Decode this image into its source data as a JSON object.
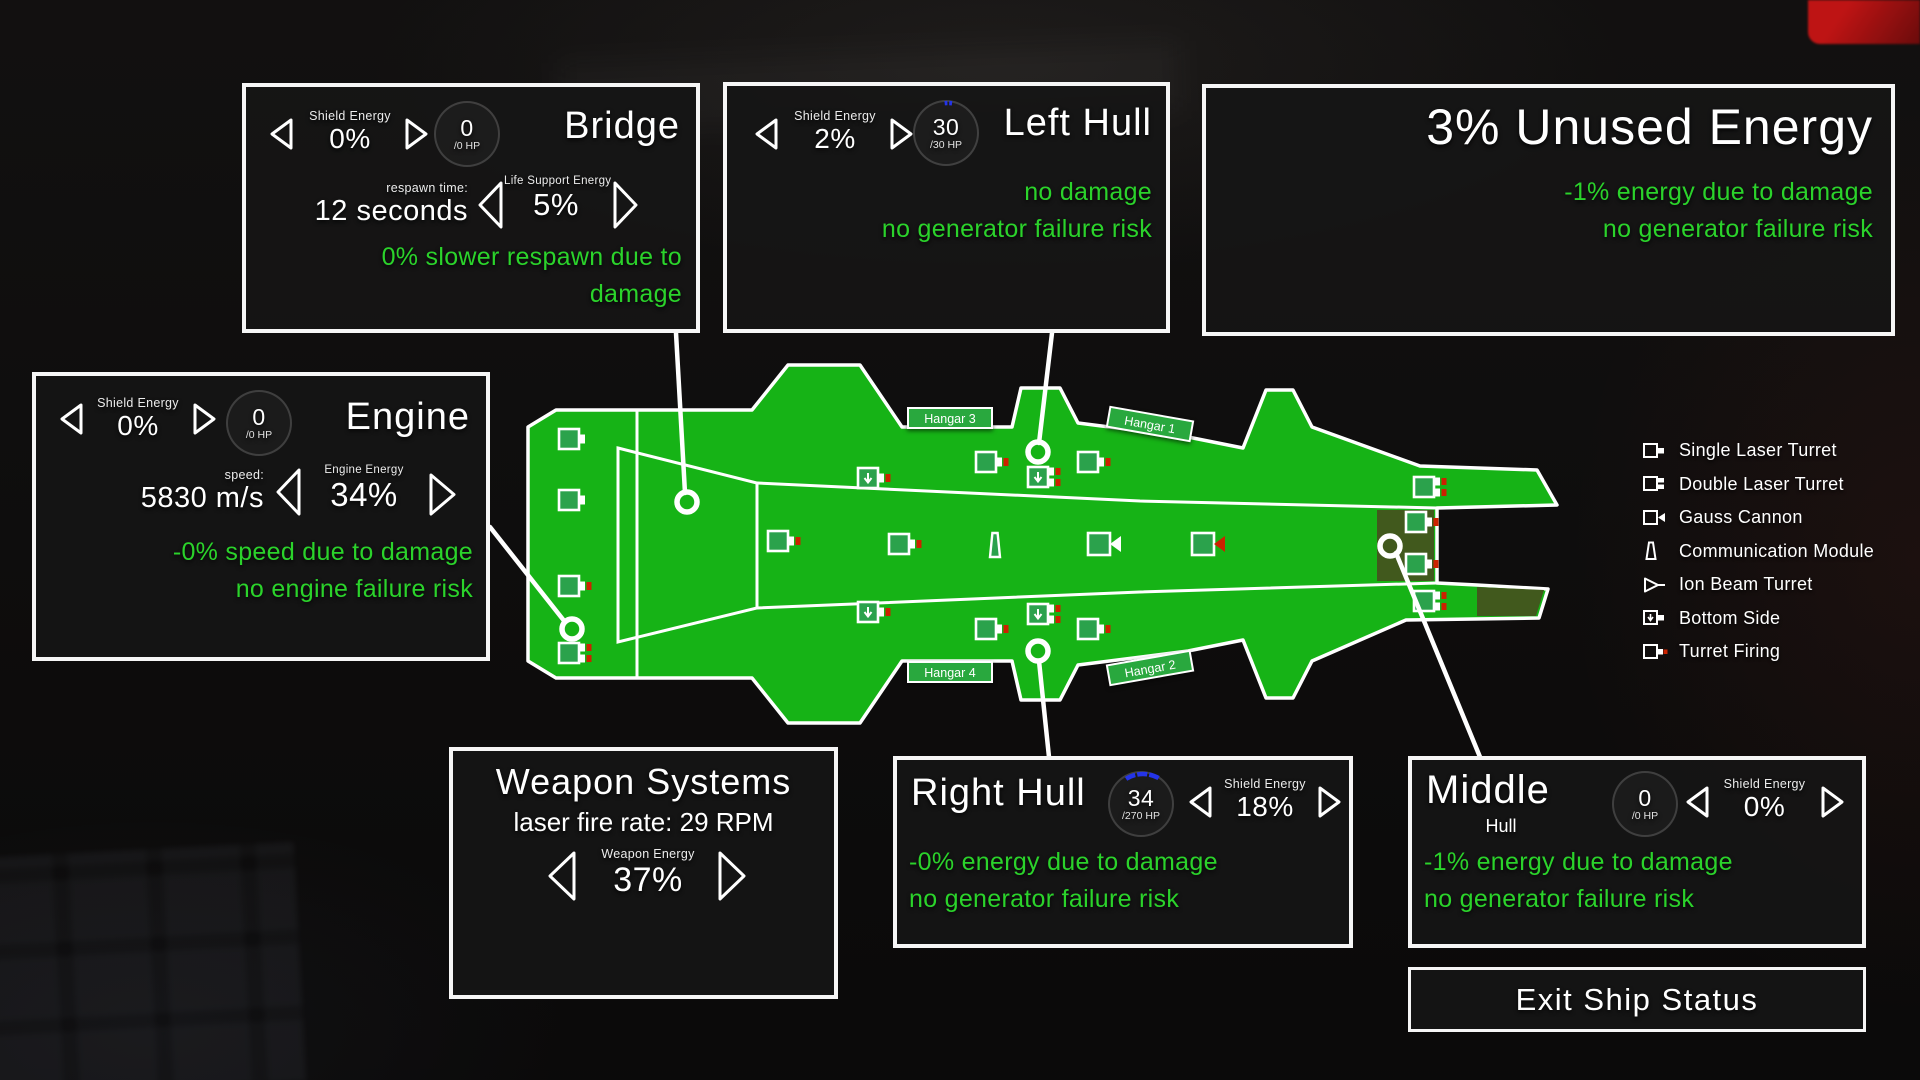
{
  "colors": {
    "hull_green": "#16b316",
    "turret_green": "#2ba24c",
    "damaged_green": "#41591d",
    "status_green": "#2bd32b",
    "firing_red": "#cc2200",
    "shield_blue": "#2434e8"
  },
  "panels": {
    "bridge": {
      "title": "Bridge",
      "shield_label": "Shield Energy",
      "shield_value": "0%",
      "hp_value": "0",
      "hp_max": "/0 HP",
      "respawn_label": "respawn time:",
      "respawn_value": "12 seconds",
      "life_support_label": "Life Support Energy",
      "life_support_value": "5%",
      "status_lines": [
        "0% slower respawn due to",
        "damage"
      ]
    },
    "left_hull": {
      "title": "Left Hull",
      "shield_label": "Shield Energy",
      "shield_value": "2%",
      "hp_value": "30",
      "hp_max": "/30 HP",
      "status_lines": [
        "no damage",
        "no generator failure risk"
      ]
    },
    "unused_energy": {
      "title": "3% Unused Energy",
      "status_lines": [
        "-1% energy due to damage",
        "no generator failure risk"
      ]
    },
    "engine": {
      "title": "Engine",
      "shield_label": "Shield Energy",
      "shield_value": "0%",
      "hp_value": "0",
      "hp_max": "/0 HP",
      "speed_label": "speed:",
      "speed_value": "5830 m/s",
      "energy_label": "Engine Energy",
      "energy_value": "34%",
      "status_lines": [
        "-0% speed due to damage",
        "no engine failure risk"
      ]
    },
    "weapon_systems": {
      "title": "Weapon Systems",
      "fire_rate": "laser fire rate: 29 RPM",
      "energy_label": "Weapon Energy",
      "energy_value": "37%"
    },
    "right_hull": {
      "title": "Right Hull",
      "shield_label": "Shield Energy",
      "shield_value": "18%",
      "hp_value": "34",
      "hp_max": "/270 HP",
      "status_lines": [
        "-0% energy due to damage",
        "no generator failure risk"
      ]
    },
    "middle_hull": {
      "title": "Middle",
      "subtitle": "Hull",
      "shield_label": "Shield Energy",
      "shield_value": "0%",
      "hp_value": "0",
      "hp_max": "/0 HP",
      "status_lines": [
        "-1% energy due to damage",
        "no generator failure risk"
      ]
    }
  },
  "exit_button_label": "Exit Ship Status",
  "legend": {
    "items": [
      {
        "icon": "single-laser-turret-icon",
        "label": "Single Laser Turret"
      },
      {
        "icon": "double-laser-turret-icon",
        "label": "Double Laser Turret"
      },
      {
        "icon": "gauss-cannon-icon",
        "label": "Gauss Cannon"
      },
      {
        "icon": "communication-module-icon",
        "label": "Communication Module"
      },
      {
        "icon": "ion-beam-turret-icon",
        "label": "Ion Beam Turret"
      },
      {
        "icon": "bottom-side-icon",
        "label": "Bottom Side"
      },
      {
        "icon": "turret-firing-icon",
        "label": "Turret Firing"
      }
    ]
  },
  "ship": {
    "hangar_labels": [
      "Hangar 1",
      "Hangar 2",
      "Hangar 3",
      "Hangar 4"
    ]
  }
}
